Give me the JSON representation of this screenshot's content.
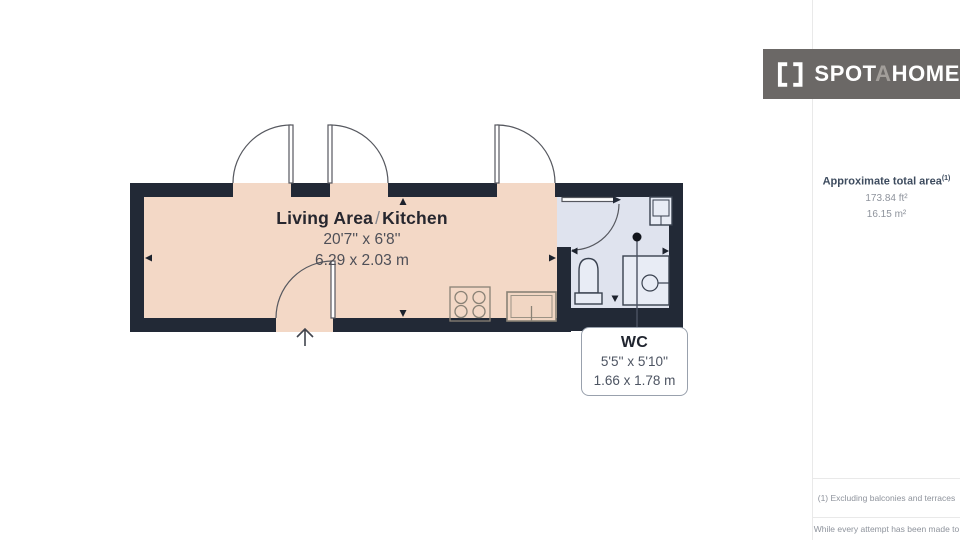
{
  "logo": {
    "part1": "SPOT",
    "part2": "A",
    "part3": "HOME"
  },
  "sidebar": {
    "area_title": "Approximate total area",
    "area_sup": "(1)",
    "area_imperial": "173.84 ft²",
    "area_metric": "16.15 m²",
    "footnote_1": "(1) Excluding balconies and terraces",
    "footnote_2": "While every attempt has been made to"
  },
  "rooms": {
    "living": {
      "name_a": "Living Area",
      "slash": "/",
      "name_b": "Kitchen",
      "imperial": "20'7'' x 6'8''",
      "metric": "6.29 x 2.03 m"
    },
    "wc": {
      "name": "WC",
      "imperial": "5'5'' x 5'10''",
      "metric": "1.66 x 1.78 m"
    }
  },
  "colors": {
    "wall": "#222936",
    "living_floor": "#f3d8c6",
    "wc_floor": "#dfe3ee",
    "fixture_stroke": "#39414f",
    "kitchen_stroke": "#8a8276",
    "logo_bg": "#6b6866",
    "accent_heading": "#3d4b5e",
    "muted_text": "#8e939c"
  }
}
